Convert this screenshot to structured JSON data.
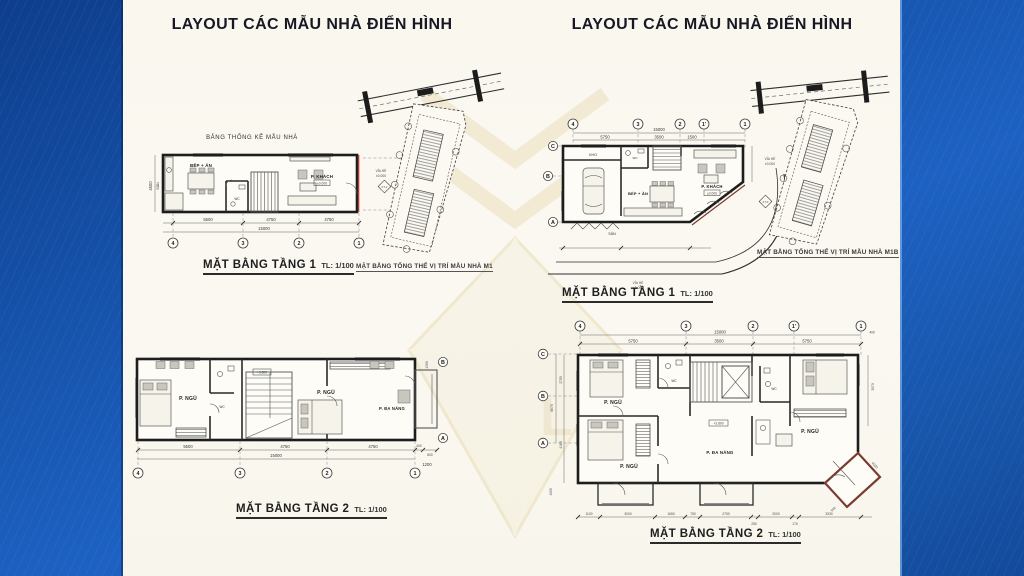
{
  "watermark": {
    "text": "LUXURY"
  },
  "left": {
    "title": "LAYOUT CÁC MẪU NHÀ ĐIỂN HÌNH",
    "plan1": {
      "header": "BẢNG THỐNG KÊ MẪU NHÀ",
      "caption": "MẶT BẰNG TẦNG 1",
      "scale": "TL: 1/100",
      "rooms": {
        "san": "SÂN",
        "bep": "BẾP + ĂN",
        "wc": "WC",
        "khach": "P. KHÁCH"
      },
      "level": "±0.000",
      "side_label": "VỈA HÈ",
      "side_level": "±0.000",
      "section_mark": "KT-2",
      "dims": [
        "5500",
        "4750",
        "4750"
      ],
      "dim_total": "15000",
      "dim_left": "4500",
      "grid_cols": [
        "4",
        "3",
        "2",
        "1"
      ],
      "grid_rows": [
        "B",
        "A"
      ]
    },
    "siteplan": {
      "caption": "MẶT BẰNG TỔNG THỂ VỊ TRÍ MẪU NHÀ M1"
    },
    "plan2": {
      "caption": "MẶT BẰNG TẦNG 2",
      "scale": "TL: 1/100",
      "rooms": {
        "ngu1": "P. NGỦ",
        "wc": "WC",
        "ngu2": "P. NGỦ",
        "danang": "P. ĐA NĂNG"
      },
      "level": "+3.800",
      "dims": [
        "5500",
        "4750",
        "4750"
      ],
      "dims_extra": [
        "400",
        "800"
      ],
      "dim_total": "15000",
      "dim_right": "1200",
      "dim_bay": "1300",
      "grid_cols": [
        "4",
        "3",
        "2",
        "1"
      ],
      "grid_rows": [
        "B",
        "A"
      ]
    }
  },
  "right": {
    "title": "LAYOUT CÁC MẪU NHÀ ĐIỂN HÌNH",
    "plan1": {
      "caption": "MẶT BẰNG TẦNG 1",
      "scale": "TL: 1/100",
      "rooms": {
        "kho": "KHO",
        "wc": "WC",
        "khach": "P. KHÁCH",
        "bep": "BẾP + ĂN",
        "san": "SÂN"
      },
      "level": "±0.000",
      "side_label": "VỈA HÈ",
      "side_level": "±0.000",
      "section_mark": "KT-3",
      "dims": [
        "5750",
        "3500",
        "1500"
      ],
      "dim_total": "15000",
      "grid_cols": [
        "4",
        "3",
        "2",
        "1'",
        "1"
      ],
      "grid_rows": [
        "C",
        "B",
        "A"
      ]
    },
    "siteplan": {
      "caption": "MẶT BẰNG TỔNG THỂ VỊ TRÍ MẪU NHÀ M1B"
    },
    "plan2": {
      "caption": "MẶT BẰNG TẦNG 2",
      "scale": "TL: 1/100",
      "rooms": {
        "ngu1": "P. NGỦ",
        "wc1": "WC",
        "ngu2": "P. NGỦ",
        "wc2": "WC",
        "ngu3": "P. NGỦ",
        "danang": "P. ĐA NĂNG"
      },
      "level": "+3.800",
      "dims_top": [
        "5750",
        "3500",
        "5750"
      ],
      "dim_total": "15000",
      "dim_400": "400",
      "dims_bottom": [
        "1100",
        "3000",
        "1650",
        "750",
        "2750",
        "250",
        "2000",
        "170",
        "3330"
      ],
      "dims_left": [
        "2700",
        "4160"
      ],
      "dims_side": [
        "6670",
        "1000"
      ],
      "dims_right": [
        "3070"
      ],
      "dims_bay": [
        "4000",
        "540"
      ],
      "grid_cols": [
        "4",
        "3",
        "2",
        "1'",
        "1"
      ],
      "grid_rows": [
        "C",
        "B",
        "A"
      ]
    }
  }
}
